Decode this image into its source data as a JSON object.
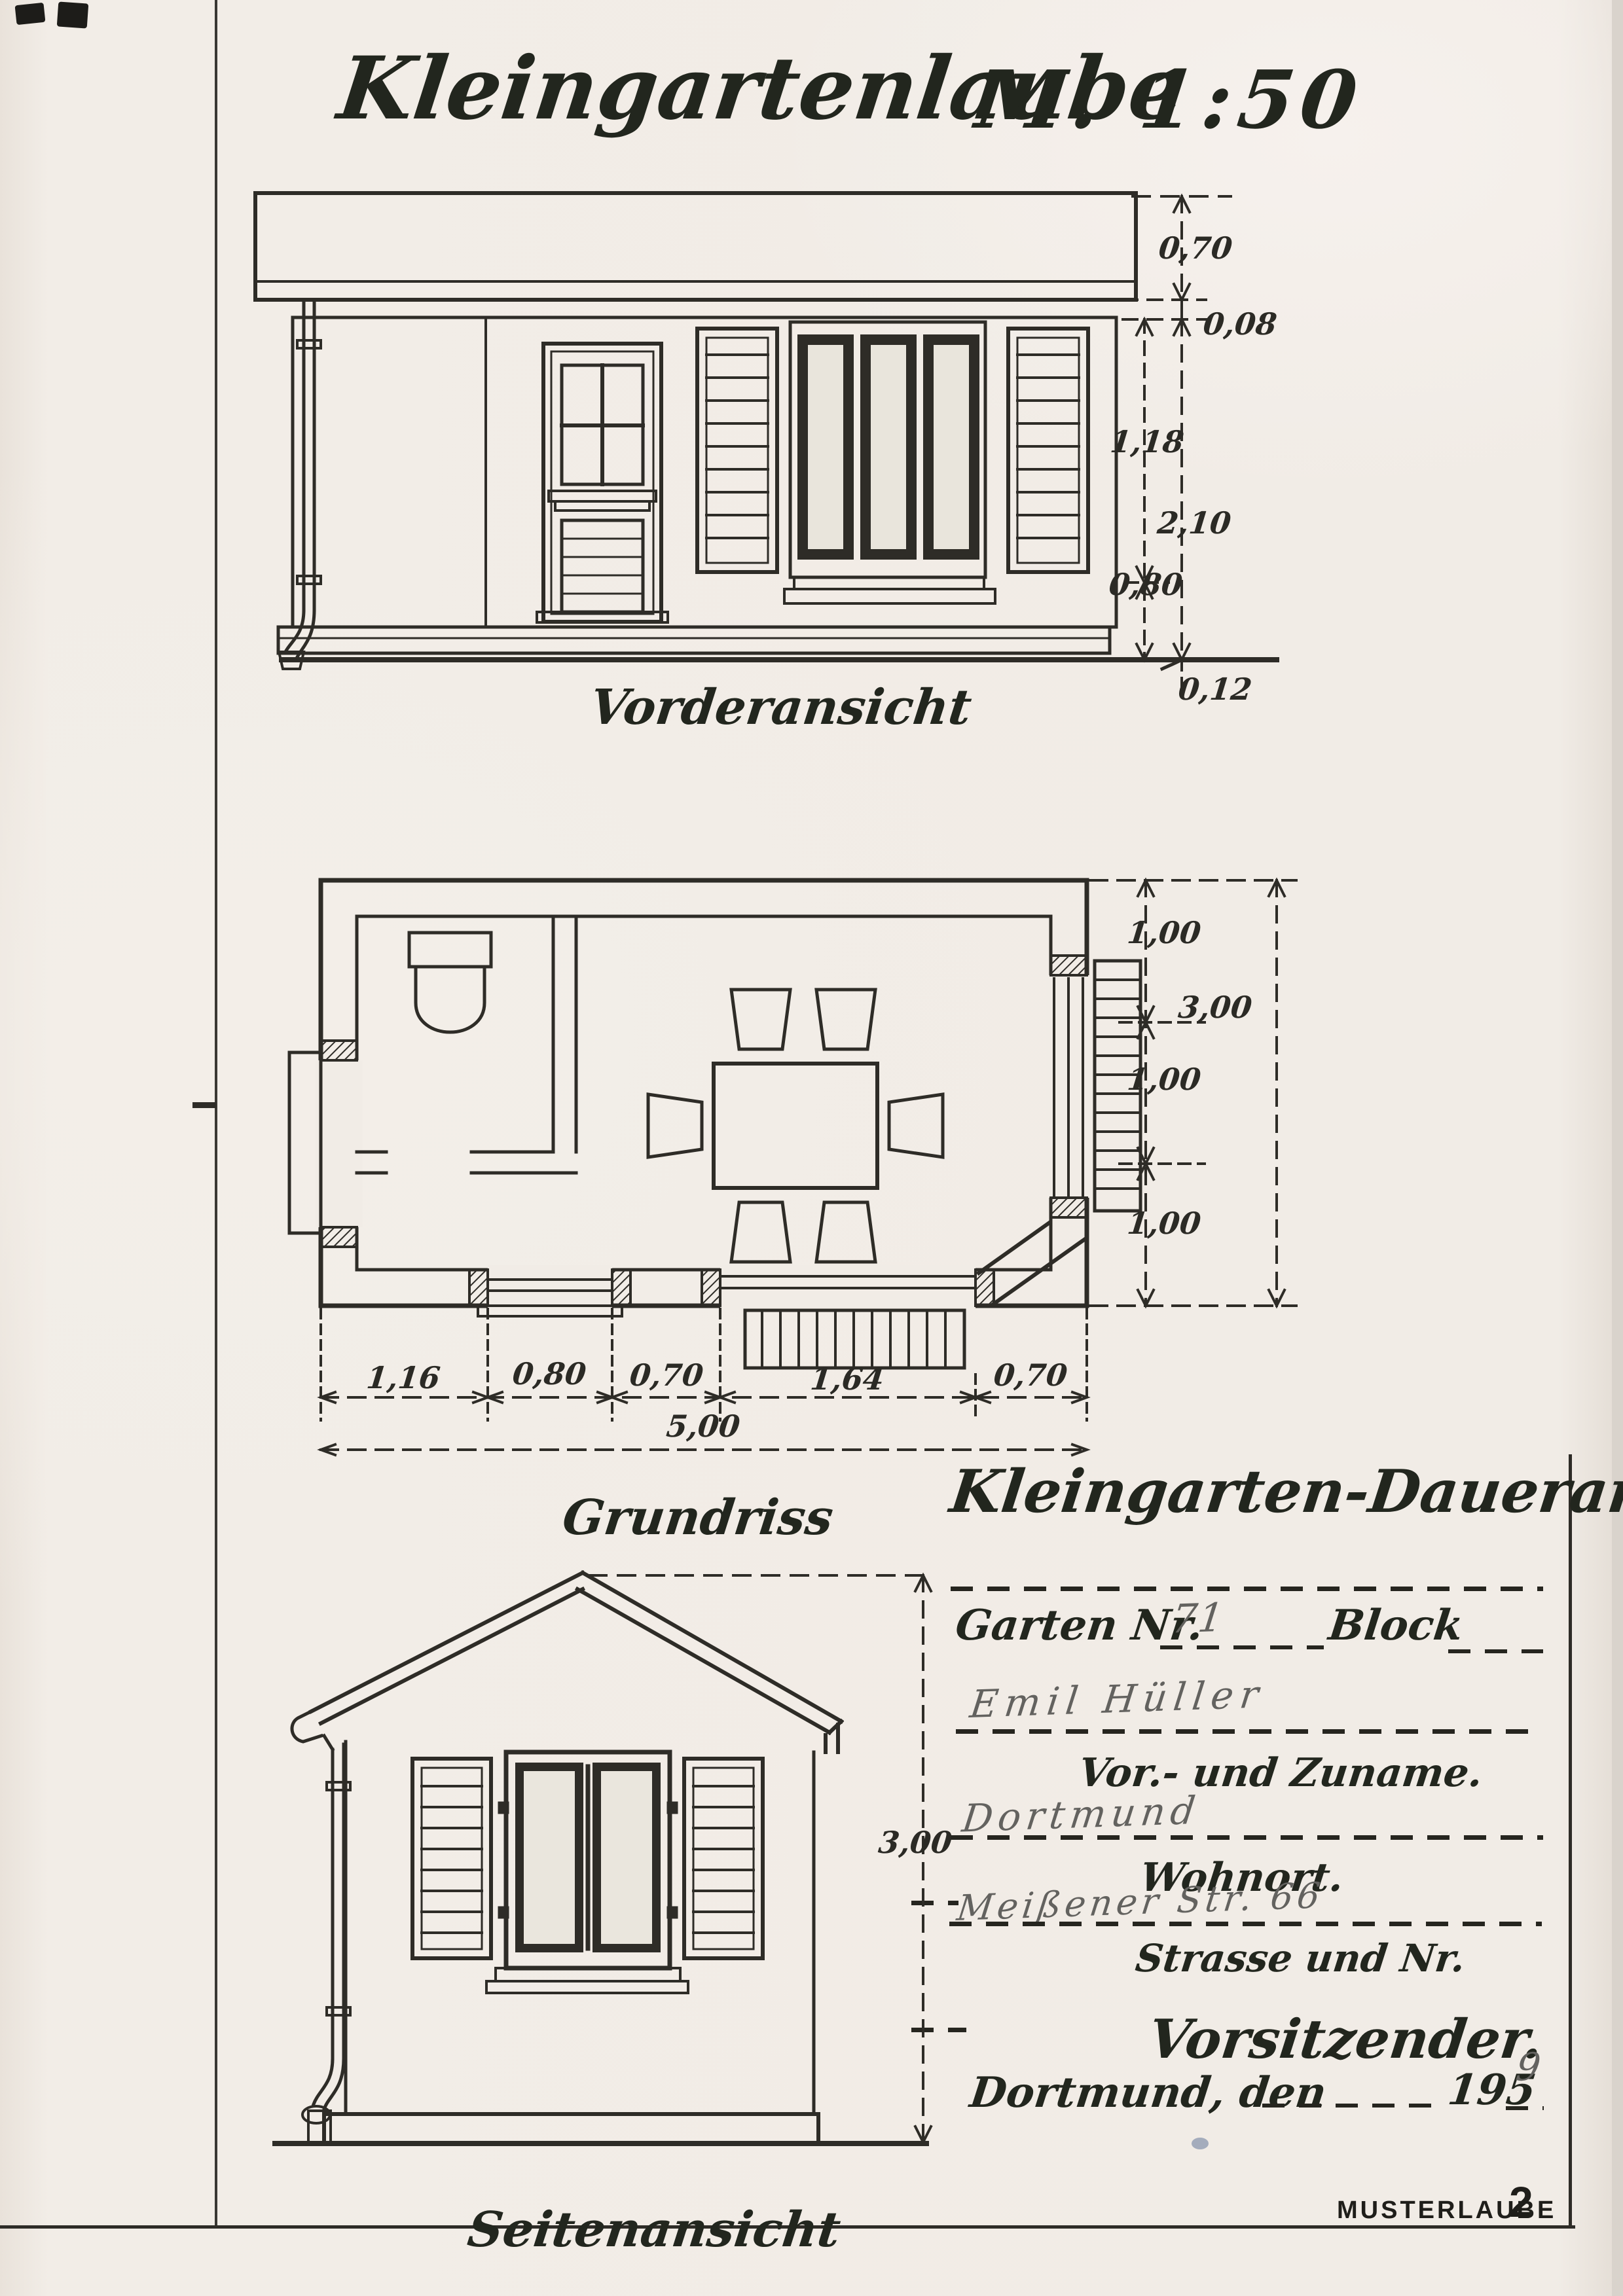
{
  "document": {
    "title": "Kleingartenlaube",
    "scale": "M. 1:50"
  },
  "front_elevation": {
    "label": "Vorderansicht",
    "dims": [
      "0,70",
      "0,08",
      "1,18",
      "2,10",
      "0,80",
      "0,12"
    ]
  },
  "floor_plan": {
    "label": "Grundriss",
    "width_dims": [
      "1,16",
      "0,80",
      "0,70",
      "1,64",
      "0,70"
    ],
    "total_width": "5,00",
    "depth_dims": [
      "1,00",
      "1,00",
      "1,00"
    ],
    "total_depth": "3,00"
  },
  "side_elevation": {
    "label": "Seitenansicht",
    "height_dim": "3,00"
  },
  "form": {
    "heading": "Kleingarten-Daueranlage",
    "garten_label": "Garten Nr.",
    "garten_value": "71",
    "block_label": "Block",
    "name_value": "Emil Hüller",
    "name_caption": "Vor.- und Zuname.",
    "city_value": "Dortmund",
    "city_caption": "Wohnort.",
    "street_value": "Meißener Str. 66",
    "street_caption": "Strasse und Nr.",
    "chairman_label": "Vorsitzender.",
    "date_prefix": "Dortmund, den",
    "date_year": "195",
    "date_year_hand": "9"
  },
  "footer": {
    "stamp": "MUSTERLAUBE",
    "sheet_number": "2"
  },
  "colors": {
    "ink": "#2e2c27",
    "title_ink": "#22261e",
    "pencil": "#63625f",
    "paper": "#f1ece6",
    "blue_speck": "#8a97ad"
  }
}
